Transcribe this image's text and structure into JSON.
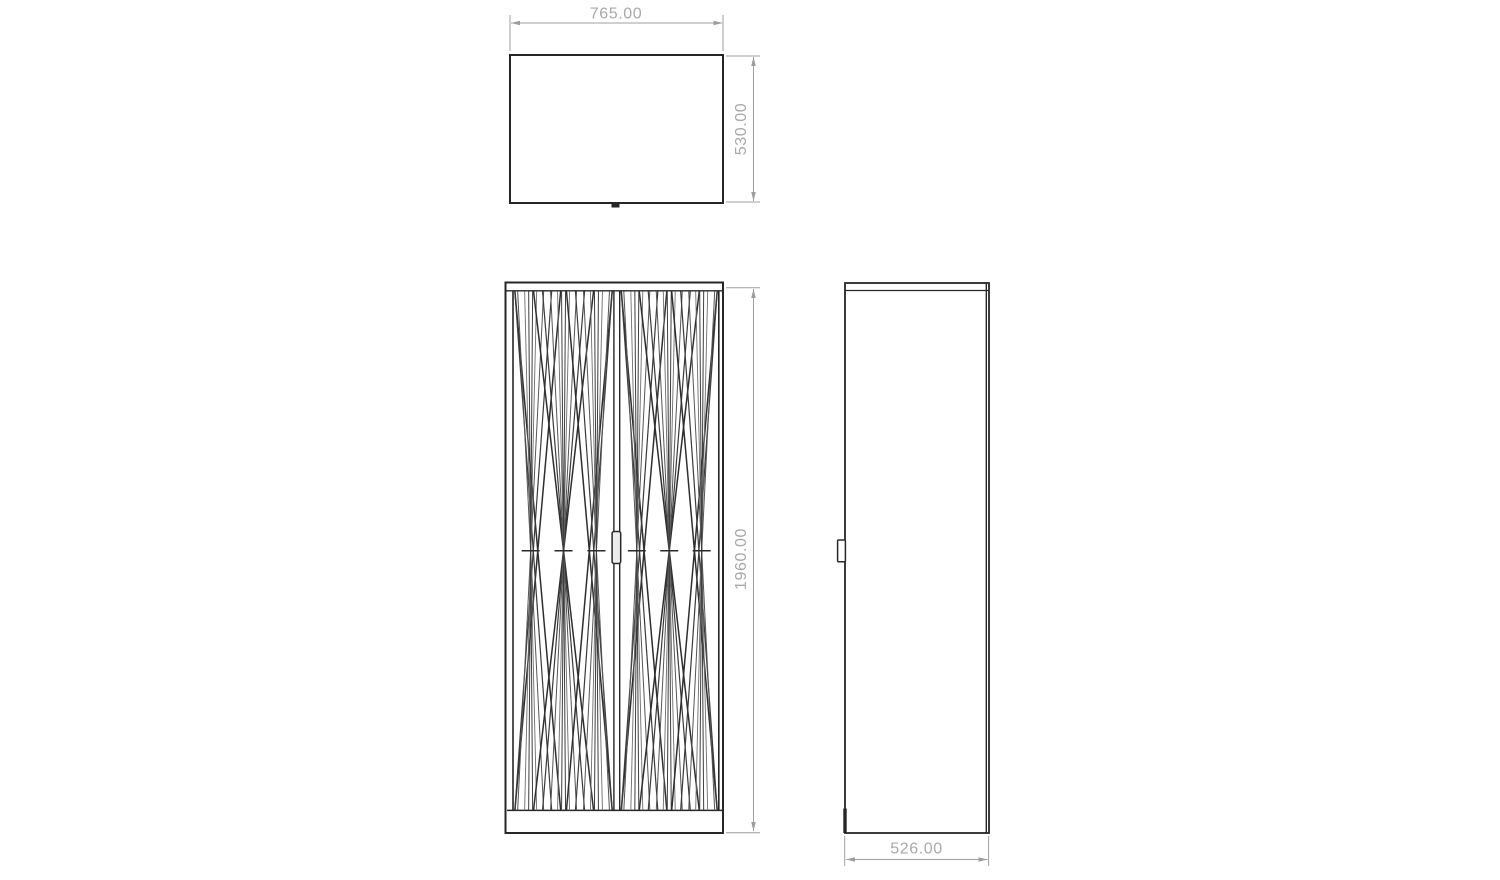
{
  "document": {
    "background": "#ffffff"
  },
  "dimensions": {
    "top_view_width": "765.00",
    "top_view_depth": "530.00",
    "front_view_height": "1960.00",
    "side_view_depth": "526.00"
  },
  "colors": {
    "outline": "#262626",
    "pattern_dark": "#2e2e2e",
    "pattern_mid": "#555555",
    "pattern_light": "#6e6e6e",
    "dimension_line": "#9f9f9f",
    "dimension_text": "#a8a8a8"
  }
}
